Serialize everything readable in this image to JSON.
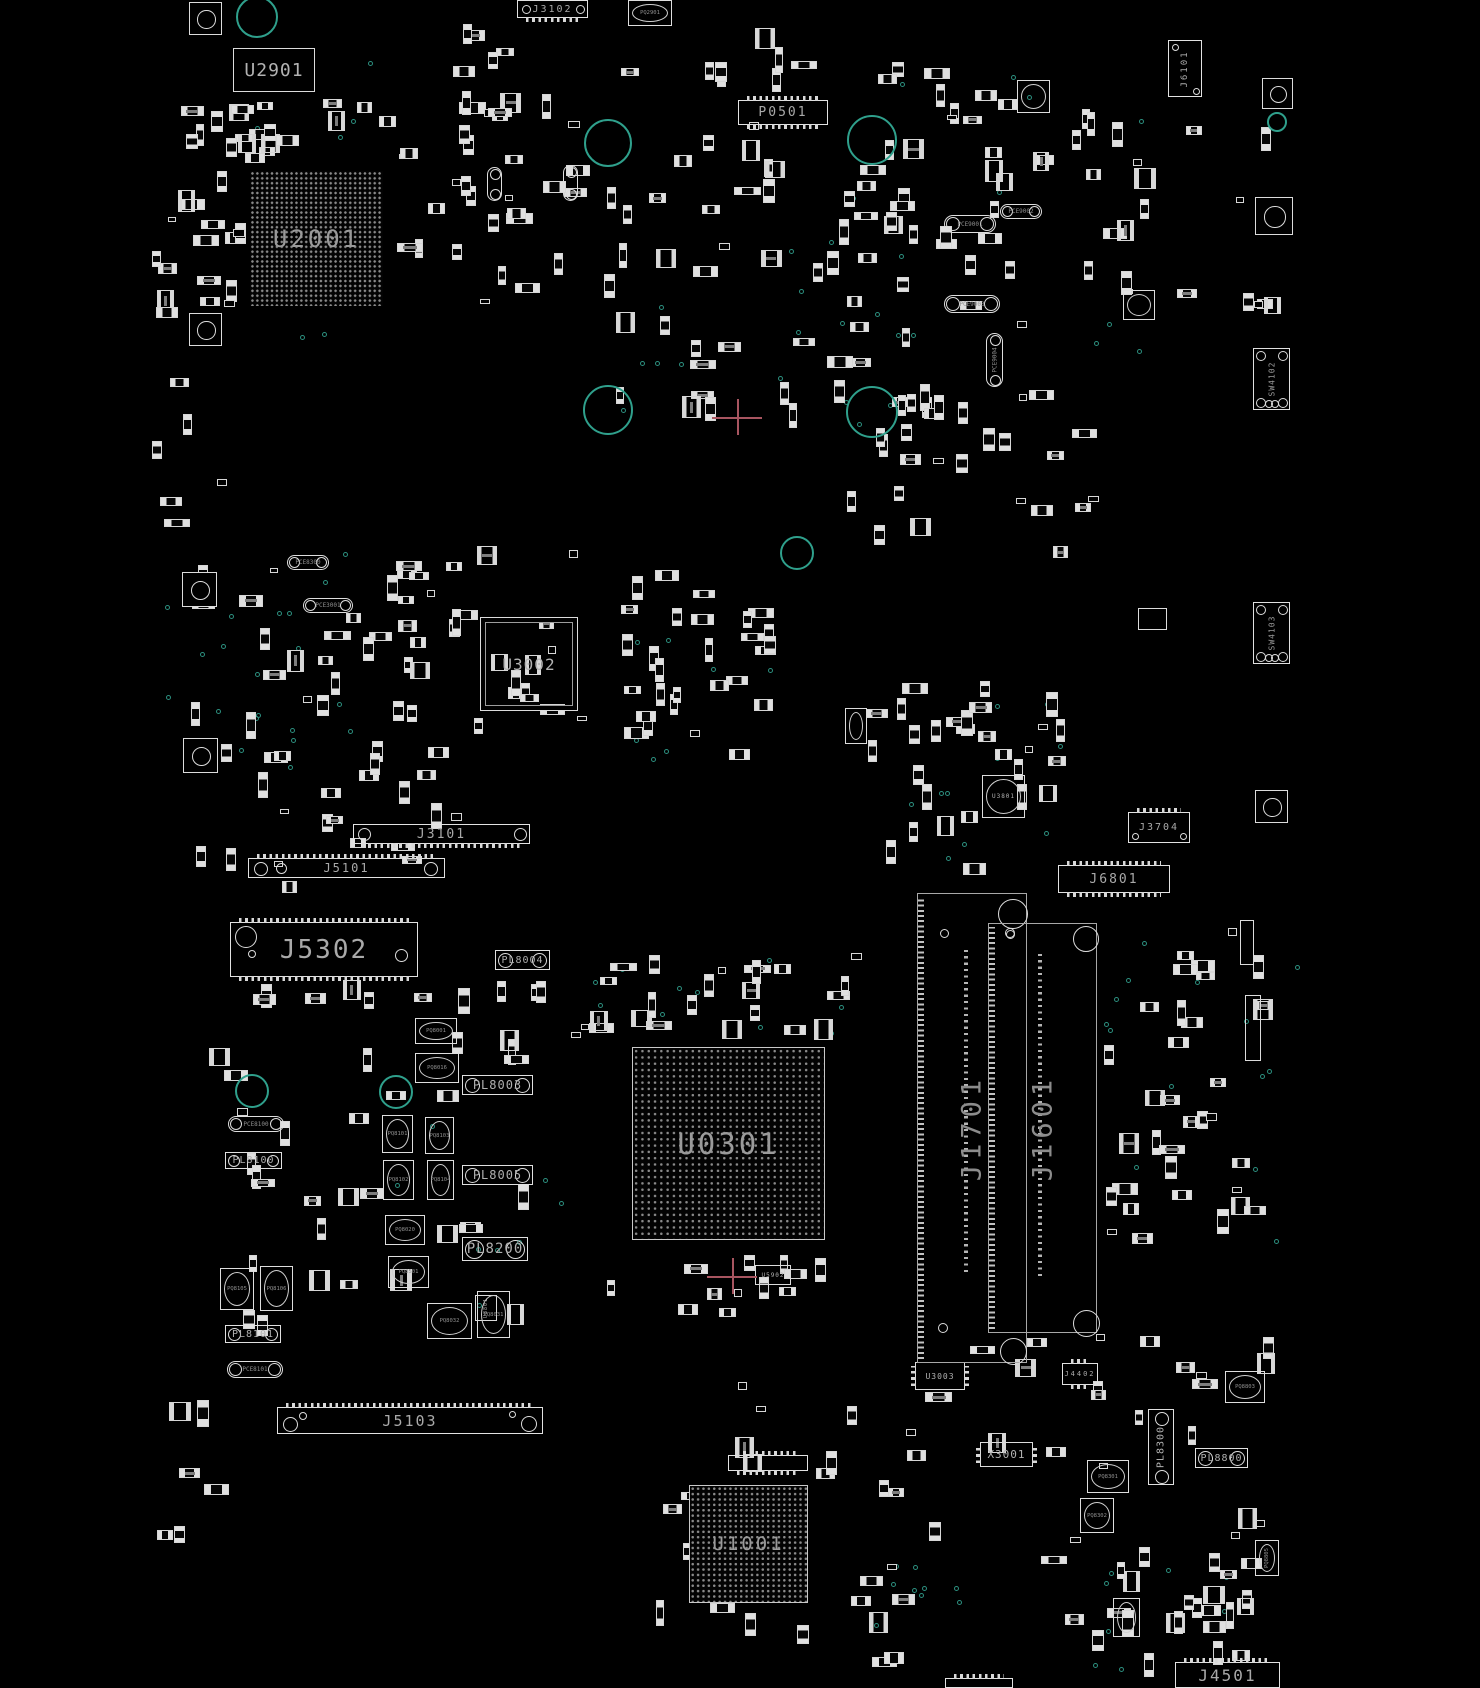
{
  "board": {
    "title": "PCB boardview",
    "background": "#000000",
    "silkscreen_color": "#d9d9d9",
    "label_color": "#a9a9a9",
    "slot_label_color": "#8c8c8c",
    "hole_color": "#2fa08c",
    "crosshair_color": "#a85560"
  },
  "components": {
    "bgas": [
      {
        "label": "U2001",
        "x": 250,
        "y": 171,
        "w": 133,
        "h": 135,
        "fs": 24,
        "pitch": 4.9,
        "border": false
      },
      {
        "label": "U0301",
        "x": 632,
        "y": 1047,
        "w": 193,
        "h": 193,
        "fs": 29,
        "pitch": 6.3,
        "border": true
      },
      {
        "label": "U1001",
        "x": 689,
        "y": 1485,
        "w": 119,
        "h": 118,
        "fs": 19,
        "pitch": 5.4,
        "border": true
      }
    ],
    "chips": [
      {
        "label": "U2901",
        "x": 233,
        "y": 48,
        "w": 82,
        "h": 44,
        "fs": 18,
        "style": "plain"
      },
      {
        "label": "U3002",
        "x": 480,
        "y": 617,
        "w": 98,
        "h": 94,
        "fs": 16,
        "style": "qfp"
      },
      {
        "label": "U3003",
        "x": 915,
        "y": 1362,
        "w": 50,
        "h": 28,
        "fs": 8,
        "style": "dip"
      },
      {
        "label": "U3801",
        "x": 982,
        "y": 775,
        "w": 43,
        "h": 43,
        "fs": 6,
        "style": "qfn"
      },
      {
        "label": "U5902",
        "x": 755,
        "y": 1265,
        "w": 36,
        "h": 20,
        "fs": 6,
        "style": "plain"
      },
      {
        "label": "U8801",
        "x": 475,
        "y": 1295,
        "w": 22,
        "h": 26,
        "fs": 5,
        "style": "plain",
        "vert": true
      },
      {
        "label": "X3001",
        "x": 980,
        "y": 1442,
        "w": 53,
        "h": 25,
        "fs": 11,
        "style": "dip"
      },
      {
        "label": "",
        "x": 1113,
        "y": 1598,
        "w": 27,
        "h": 39,
        "fs": 0,
        "style": "qfn"
      },
      {
        "label": "",
        "x": 1017,
        "y": 80,
        "w": 33,
        "h": 33,
        "fs": 0,
        "style": "qfn"
      },
      {
        "label": "",
        "x": 1123,
        "y": 290,
        "w": 32,
        "h": 30,
        "fs": 0,
        "style": "qfn"
      },
      {
        "label": "",
        "x": 1138,
        "y": 608,
        "w": 29,
        "h": 22,
        "fs": 0,
        "style": "plain"
      },
      {
        "label": "",
        "x": 845,
        "y": 708,
        "w": 22,
        "h": 36,
        "fs": 0,
        "style": "qfn"
      },
      {
        "label": "",
        "x": 1245,
        "y": 995,
        "w": 16,
        "h": 66,
        "fs": 0,
        "style": "plain"
      },
      {
        "label": "",
        "x": 1240,
        "y": 920,
        "w": 14,
        "h": 45,
        "fs": 0,
        "style": "plain"
      }
    ],
    "connectors": [
      {
        "label": "J3102",
        "x": 517,
        "y": 0,
        "w": 71,
        "h": 18,
        "fs": 10,
        "teeth": "bottom",
        "holes": [
          [
            4,
            4,
            9
          ],
          [
            58,
            4,
            9
          ]
        ]
      },
      {
        "label": "P0501",
        "x": 738,
        "y": 100,
        "w": 90,
        "h": 25,
        "fs": 13,
        "teeth": "both",
        "holes": []
      },
      {
        "label": "J6101",
        "x": 1168,
        "y": 40,
        "w": 34,
        "h": 57,
        "fs": 9,
        "vert": true,
        "teeth": "none",
        "holes": [
          [
            3,
            3,
            7
          ],
          [
            24,
            47,
            7
          ]
        ]
      },
      {
        "label": "J3101",
        "x": 353,
        "y": 824,
        "w": 177,
        "h": 20,
        "fs": 13,
        "teeth": "bottom",
        "holes": [
          [
            4,
            3,
            13
          ],
          [
            160,
            3,
            13
          ]
        ]
      },
      {
        "label": "J5101",
        "x": 248,
        "y": 858,
        "w": 197,
        "h": 20,
        "fs": 12,
        "teeth": "top",
        "holes": [
          [
            5,
            3,
            14
          ],
          [
            27,
            4,
            11
          ],
          [
            175,
            3,
            14
          ]
        ]
      },
      {
        "label": "J5302",
        "x": 230,
        "y": 922,
        "w": 188,
        "h": 55,
        "fs": 26,
        "teeth": "both",
        "holes": [
          [
            4,
            3,
            22
          ],
          [
            164,
            26,
            13
          ],
          [
            17,
            27,
            8
          ]
        ]
      },
      {
        "label": "J6801",
        "x": 1058,
        "y": 865,
        "w": 112,
        "h": 28,
        "fs": 13,
        "teeth": "both",
        "holes": []
      },
      {
        "label": "J3704",
        "x": 1128,
        "y": 812,
        "w": 62,
        "h": 31,
        "fs": 10,
        "teeth": "top",
        "holes": [
          [
            3,
            20,
            7
          ],
          [
            51,
            20,
            7
          ]
        ]
      },
      {
        "label": "J5103",
        "x": 277,
        "y": 1407,
        "w": 266,
        "h": 27,
        "fs": 15,
        "teeth": "top",
        "holes": [
          [
            5,
            9,
            15
          ],
          [
            21,
            4,
            8
          ],
          [
            243,
            8,
            16
          ],
          [
            231,
            3,
            7
          ]
        ]
      },
      {
        "label": "J4501",
        "x": 1175,
        "y": 1662,
        "w": 105,
        "h": 26,
        "fs": 16,
        "teeth": "top",
        "holes": []
      },
      {
        "label": "J4402",
        "x": 1062,
        "y": 1363,
        "w": 36,
        "h": 22,
        "fs": 7,
        "teeth": "both",
        "holes": []
      },
      {
        "label": "",
        "x": 945,
        "y": 1678,
        "w": 68,
        "h": 10,
        "fs": 8,
        "teeth": "top",
        "holes": []
      },
      {
        "label": "",
        "x": 728,
        "y": 1455,
        "w": 80,
        "h": 16,
        "fs": 8,
        "teeth": "both",
        "holes": []
      }
    ],
    "slots": [
      {
        "label": "J1701",
        "x": 917,
        "y": 893,
        "w": 110,
        "h": 470,
        "fs": 27,
        "circles": [
          [
            80,
            5,
            30
          ],
          [
            22,
            35,
            9
          ],
          [
            88,
            36,
            9
          ],
          [
            82,
            444,
            27
          ],
          [
            20,
            429,
            10
          ]
        ],
        "strip_x": 46,
        "strip_y1": 52,
        "strip_y2": 378
      },
      {
        "label": "J1601",
        "x": 988,
        "y": 923,
        "w": 109,
        "h": 410,
        "fs": 27,
        "circles": [
          [
            84,
            2,
            26
          ],
          [
            16,
            4,
            10
          ],
          [
            84,
            386,
            27
          ]
        ],
        "strip_x": 49,
        "strip_y1": 30,
        "strip_y2": 352
      }
    ],
    "switches": [
      {
        "label": "SW4102",
        "x": 1253,
        "y": 348,
        "w": 37,
        "h": 62,
        "fs": 8
      },
      {
        "label": "SW4103",
        "x": 1253,
        "y": 602,
        "w": 37,
        "h": 62,
        "fs": 8
      }
    ],
    "inductors": [
      {
        "label": "PL8003",
        "x": 462,
        "y": 1075,
        "w": 71,
        "h": 20,
        "fs": 12
      },
      {
        "label": "PL8005",
        "x": 462,
        "y": 1165,
        "w": 71,
        "h": 20,
        "fs": 12
      },
      {
        "label": "PL8200",
        "x": 462,
        "y": 1237,
        "w": 66,
        "h": 24,
        "fs": 14
      },
      {
        "label": "PL8100",
        "x": 225,
        "y": 1152,
        "w": 57,
        "h": 17,
        "fs": 10
      },
      {
        "label": "PL8101",
        "x": 225,
        "y": 1325,
        "w": 56,
        "h": 18,
        "fs": 10
      },
      {
        "label": "PL8004",
        "x": 495,
        "y": 950,
        "w": 55,
        "h": 20,
        "fs": 10
      },
      {
        "label": "PL8300",
        "x": 1148,
        "y": 1409,
        "w": 26,
        "h": 76,
        "fs": 10,
        "vert": true
      },
      {
        "label": "PL8800",
        "x": 1195,
        "y": 1448,
        "w": 53,
        "h": 20,
        "fs": 10
      }
    ],
    "capacitors": [
      {
        "label": "PCE8100",
        "x": 228,
        "y": 1116,
        "w": 56,
        "h": 16
      },
      {
        "label": "PCE8101",
        "x": 227,
        "y": 1361,
        "w": 56,
        "h": 17
      },
      {
        "label": "PCE9001",
        "x": 944,
        "y": 215,
        "w": 52,
        "h": 18
      },
      {
        "label": "PCE9002",
        "x": 1000,
        "y": 204,
        "w": 42,
        "h": 15
      },
      {
        "label": "PCE9003",
        "x": 944,
        "y": 295,
        "w": 56,
        "h": 18
      },
      {
        "label": "PCE9004",
        "x": 986,
        "y": 333,
        "w": 17,
        "h": 54,
        "vert": true
      },
      {
        "label": "PCE8300",
        "x": 287,
        "y": 555,
        "w": 42,
        "h": 15
      },
      {
        "label": "PCE3001",
        "x": 303,
        "y": 598,
        "w": 50,
        "h": 15
      },
      {
        "label": "",
        "x": 487,
        "y": 167,
        "w": 15,
        "h": 34,
        "vert": true
      },
      {
        "label": "",
        "x": 563,
        "y": 165,
        "w": 15,
        "h": 36,
        "vert": true
      }
    ],
    "fets": [
      {
        "label": "PQ2901",
        "x": 628,
        "y": 0,
        "w": 44,
        "h": 26
      },
      {
        "label": "PQ8001",
        "x": 415,
        "y": 1018,
        "w": 42,
        "h": 26
      },
      {
        "label": "PQ8016",
        "x": 415,
        "y": 1053,
        "w": 44,
        "h": 30
      },
      {
        "label": "PQ8101",
        "x": 382,
        "y": 1115,
        "w": 31,
        "h": 38
      },
      {
        "label": "PQ8102",
        "x": 383,
        "y": 1160,
        "w": 31,
        "h": 40
      },
      {
        "label": "PQ8103",
        "x": 425,
        "y": 1117,
        "w": 29,
        "h": 37
      },
      {
        "label": "PQ8104",
        "x": 427,
        "y": 1160,
        "w": 27,
        "h": 40
      },
      {
        "label": "PQ8020",
        "x": 385,
        "y": 1215,
        "w": 40,
        "h": 30
      },
      {
        "label": "PQ8501",
        "x": 388,
        "y": 1256,
        "w": 41,
        "h": 32
      },
      {
        "label": "PQ8105",
        "x": 220,
        "y": 1268,
        "w": 34,
        "h": 42
      },
      {
        "label": "PQ8106",
        "x": 260,
        "y": 1266,
        "w": 33,
        "h": 45
      },
      {
        "label": "PQ8032",
        "x": 427,
        "y": 1303,
        "w": 45,
        "h": 36
      },
      {
        "label": "PQ8031",
        "x": 477,
        "y": 1291,
        "w": 33,
        "h": 47
      },
      {
        "label": "PQ8301",
        "x": 1087,
        "y": 1460,
        "w": 42,
        "h": 33
      },
      {
        "label": "PQ8302",
        "x": 1080,
        "y": 1498,
        "w": 34,
        "h": 35
      },
      {
        "label": "PQ8803",
        "x": 1225,
        "y": 1371,
        "w": 40,
        "h": 32
      },
      {
        "label": "PQ8805",
        "x": 1255,
        "y": 1540,
        "w": 24,
        "h": 36,
        "vert": true
      }
    ]
  },
  "fiducials": [
    [
      189,
      2,
      33
    ],
    [
      189,
      313,
      33
    ],
    [
      1262,
      78,
      31
    ],
    [
      1255,
      197,
      38
    ],
    [
      1255,
      790,
      33
    ],
    [
      182,
      572,
      35
    ],
    [
      183,
      738,
      35
    ]
  ],
  "holes": [
    [
      257,
      17,
      21
    ],
    [
      608,
      143,
      24
    ],
    [
      872,
      140,
      25
    ],
    [
      608,
      410,
      25
    ],
    [
      872,
      412,
      26
    ],
    [
      797,
      553,
      17
    ],
    [
      1277,
      122,
      10
    ],
    [
      252,
      1091,
      17
    ],
    [
      396,
      1092,
      17
    ]
  ],
  "crosshairs": [
    [
      737,
      417
    ],
    [
      732,
      1276
    ]
  ],
  "via_clusters": [
    [
      600,
      185,
      320,
      255,
      22
    ],
    [
      230,
      540,
      120,
      230,
      14
    ],
    [
      150,
      600,
      110,
      180,
      8
    ],
    [
      860,
      1555,
      110,
      70,
      10
    ],
    [
      620,
      620,
      160,
      140,
      8
    ],
    [
      1100,
      930,
      200,
      330,
      14
    ],
    [
      560,
      950,
      300,
      90,
      10
    ],
    [
      840,
      690,
      220,
      190,
      10
    ],
    [
      1040,
      1560,
      200,
      120,
      8
    ],
    [
      380,
      1020,
      180,
      320,
      8
    ],
    [
      230,
      60,
      200,
      290,
      8
    ],
    [
      900,
      60,
      260,
      290,
      10
    ]
  ],
  "part_clusters": [
    [
      175,
      95,
      245,
      70,
      22
    ],
    [
      165,
      170,
      85,
      180,
      16
    ],
    [
      395,
      90,
      200,
      220,
      26
    ],
    [
      440,
      20,
      120,
      100,
      8
    ],
    [
      600,
      60,
      190,
      280,
      20
    ],
    [
      845,
      55,
      315,
      300,
      45
    ],
    [
      1150,
      120,
      140,
      240,
      8
    ],
    [
      180,
      550,
      290,
      350,
      45
    ],
    [
      390,
      540,
      200,
      220,
      24
    ],
    [
      615,
      560,
      170,
      220,
      28
    ],
    [
      600,
      185,
      320,
      250,
      24
    ],
    [
      830,
      380,
      290,
      180,
      24
    ],
    [
      860,
      680,
      210,
      200,
      28
    ],
    [
      1100,
      900,
      190,
      360,
      34
    ],
    [
      235,
      980,
      330,
      35,
      10
    ],
    [
      185,
      1020,
      370,
      320,
      30
    ],
    [
      565,
      950,
      300,
      90,
      24
    ],
    [
      600,
      1250,
      260,
      80,
      12
    ],
    [
      610,
      1370,
      350,
      300,
      30
    ],
    [
      965,
      1330,
      330,
      330,
      30
    ],
    [
      1060,
      1560,
      220,
      120,
      16
    ],
    [
      150,
      350,
      80,
      180,
      6
    ],
    [
      150,
      1390,
      90,
      180,
      6
    ],
    [
      700,
      0,
      120,
      90,
      6
    ],
    [
      905,
      380,
      80,
      60,
      5
    ],
    [
      150,
      200,
      30,
      150,
      4
    ]
  ]
}
